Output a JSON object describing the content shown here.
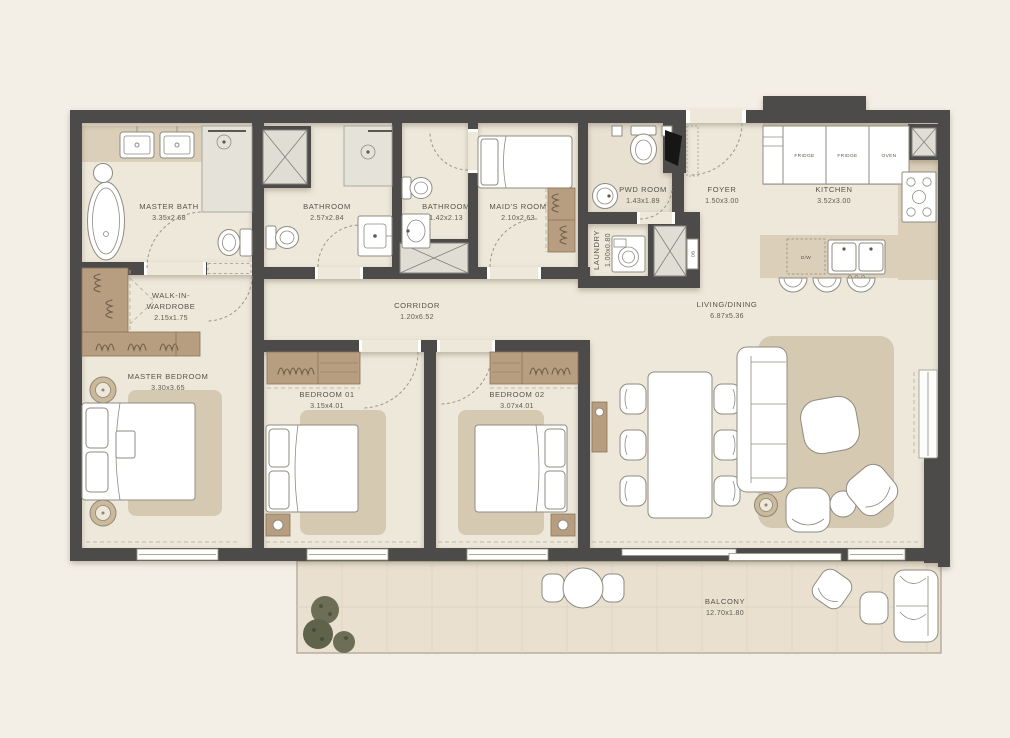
{
  "canvas": {
    "width": 1010,
    "height": 738
  },
  "colors": {
    "background": "#f4efe6",
    "wall": "#4e4c49",
    "floor": "#eee8da",
    "counter": "#dbcfb9",
    "rug": "#d5c9b2",
    "wood": "#b79e80",
    "balcony_floor": "#e9e0cf",
    "shaft": "#e0ddd5",
    "plant": "#676b51",
    "label_text": "#56544c"
  },
  "rooms": {
    "master_bath": {
      "name": "MASTER BATH",
      "dims": "3.35x2.68"
    },
    "bathroom_main": {
      "name": "BATHROOM",
      "dims": "2.57x2.84"
    },
    "bathroom_small": {
      "name": "BATHROOM",
      "dims": "1.42x2.13"
    },
    "maids_room": {
      "name": "MAID'S ROOM",
      "dims": "2.10x2.63"
    },
    "pwd_room": {
      "name": "PWD ROOM",
      "dims": "1.43x1.89"
    },
    "laundry": {
      "name": "LAUNDRY",
      "dims": "1.00x0.80"
    },
    "foyer": {
      "name": "FOYER",
      "dims": "1.50x3.00"
    },
    "kitchen": {
      "name": "KITCHEN",
      "dims": "3.52x3.00"
    },
    "walk_in_wardrobe": {
      "line1": "WALK-IN-",
      "line2": "WARDROBE",
      "dims": "2.15x1.75"
    },
    "corridor": {
      "name": "CORRIDOR",
      "dims": "1.20x6.52"
    },
    "master_bedroom": {
      "name": "MASTER BEDROOM",
      "dims": "3.30x3.65"
    },
    "bedroom_01": {
      "name": "BEDROOM 01",
      "dims": "3.15x4.01"
    },
    "bedroom_02": {
      "name": "BEDROOM 02",
      "dims": "3.07x4.01"
    },
    "living_dining": {
      "name": "LIVING/DINING",
      "dims": "6.87x5.36"
    },
    "balcony": {
      "name": "BALCONY",
      "dims": "12.70x1.80"
    }
  },
  "appliances": {
    "fridge_1": "FRIDGE",
    "fridge_2": "FRIDGE",
    "oven": "OVEN",
    "dishwasher": "D/W",
    "db_panel": "DB"
  }
}
